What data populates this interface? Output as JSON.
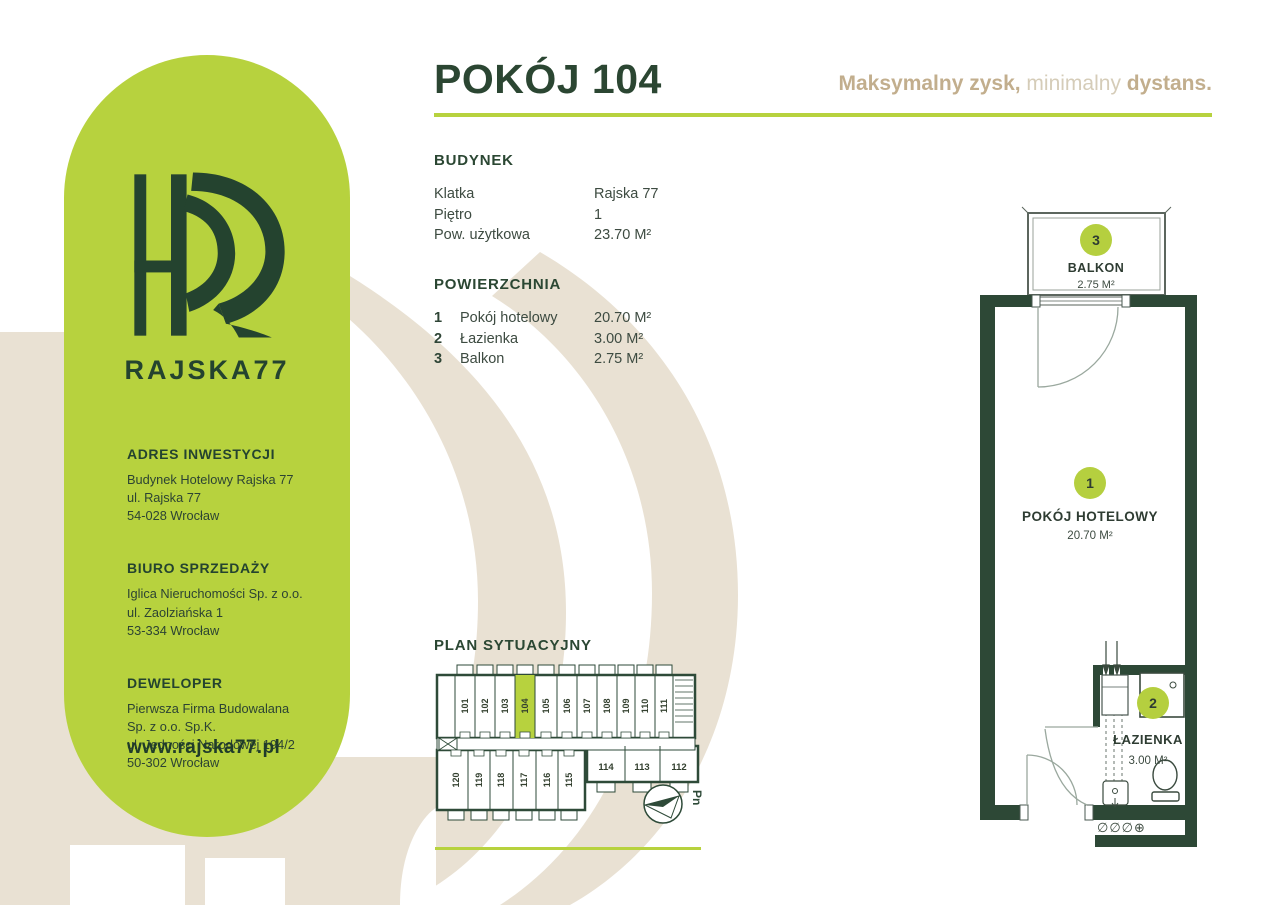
{
  "header": {
    "title": "POKÓJ 104",
    "tagline": {
      "bold1": "Maksymalny zysk,",
      "light": " minimalny ",
      "bold2": "dystans."
    }
  },
  "brand": {
    "name": "RAJSKA77",
    "logo": "rajska77-monogram"
  },
  "sidebar": {
    "sections": [
      {
        "heading": "ADRES INWESTYCJI",
        "lines": [
          "Budynek Hotelowy Rajska 77",
          "ul. Rajska 77",
          "54-028 Wrocław"
        ]
      },
      {
        "heading": "BIURO SPRZEDAŻY",
        "lines": [
          "Iglica Nieruchomości Sp. z o.o.",
          "ul. Zaolziańska 1",
          "53-334 Wrocław"
        ]
      },
      {
        "heading": "DEWELOPER",
        "lines": [
          "Pierwsza Firma Budowalana",
          "Sp. z o.o. Sp.K.",
          "ul. Jedności Narodowej 194/2",
          "50-302 Wrocław"
        ]
      }
    ],
    "website": "www.rajska77.pl"
  },
  "budynek": {
    "heading": "BUDYNEK",
    "rows": [
      {
        "label": "Klatka",
        "value": "Rajska 77"
      },
      {
        "label": "Piętro",
        "value": "1"
      },
      {
        "label": "Pow. użytkowa",
        "value": "23.70 M²"
      }
    ]
  },
  "powierzchnia": {
    "heading": "POWIERZCHNIA",
    "rows": [
      {
        "num": "1",
        "label": "Pokój hotelowy",
        "value": "20.70 M²"
      },
      {
        "num": "2",
        "label": "Łazienka",
        "value": "3.00 M²"
      },
      {
        "num": "3",
        "label": "Balkon",
        "value": "2.75 M²"
      }
    ]
  },
  "floorplan": {
    "rooms": [
      {
        "num": "1",
        "name": "POKÓJ HOTELOWY",
        "area": "20.70 M²"
      },
      {
        "num": "2",
        "name": "ŁAZIENKA",
        "area": "3.00 M²"
      },
      {
        "num": "3",
        "name": "BALKON",
        "area": "2.75 M²"
      }
    ],
    "utility_symbols": "∅∅∅⊕"
  },
  "siteplan": {
    "heading": "PLAN SYTUACYJNY",
    "highlighted_room": "104",
    "top_rooms": [
      "101",
      "102",
      "103",
      "104",
      "105",
      "106",
      "107",
      "108",
      "109",
      "110",
      "111"
    ],
    "bottom_rooms": [
      "120",
      "119",
      "118",
      "117",
      "116",
      "115"
    ],
    "right_rooms": [
      "114",
      "113",
      "112"
    ],
    "compass_label": "Pn"
  },
  "colors": {
    "lime": "#b7d23e",
    "dark_green": "#2c4a36",
    "beige": "#e9e1d3",
    "tan": "#c2ae8d",
    "tan_light": "#d5ccb8"
  }
}
